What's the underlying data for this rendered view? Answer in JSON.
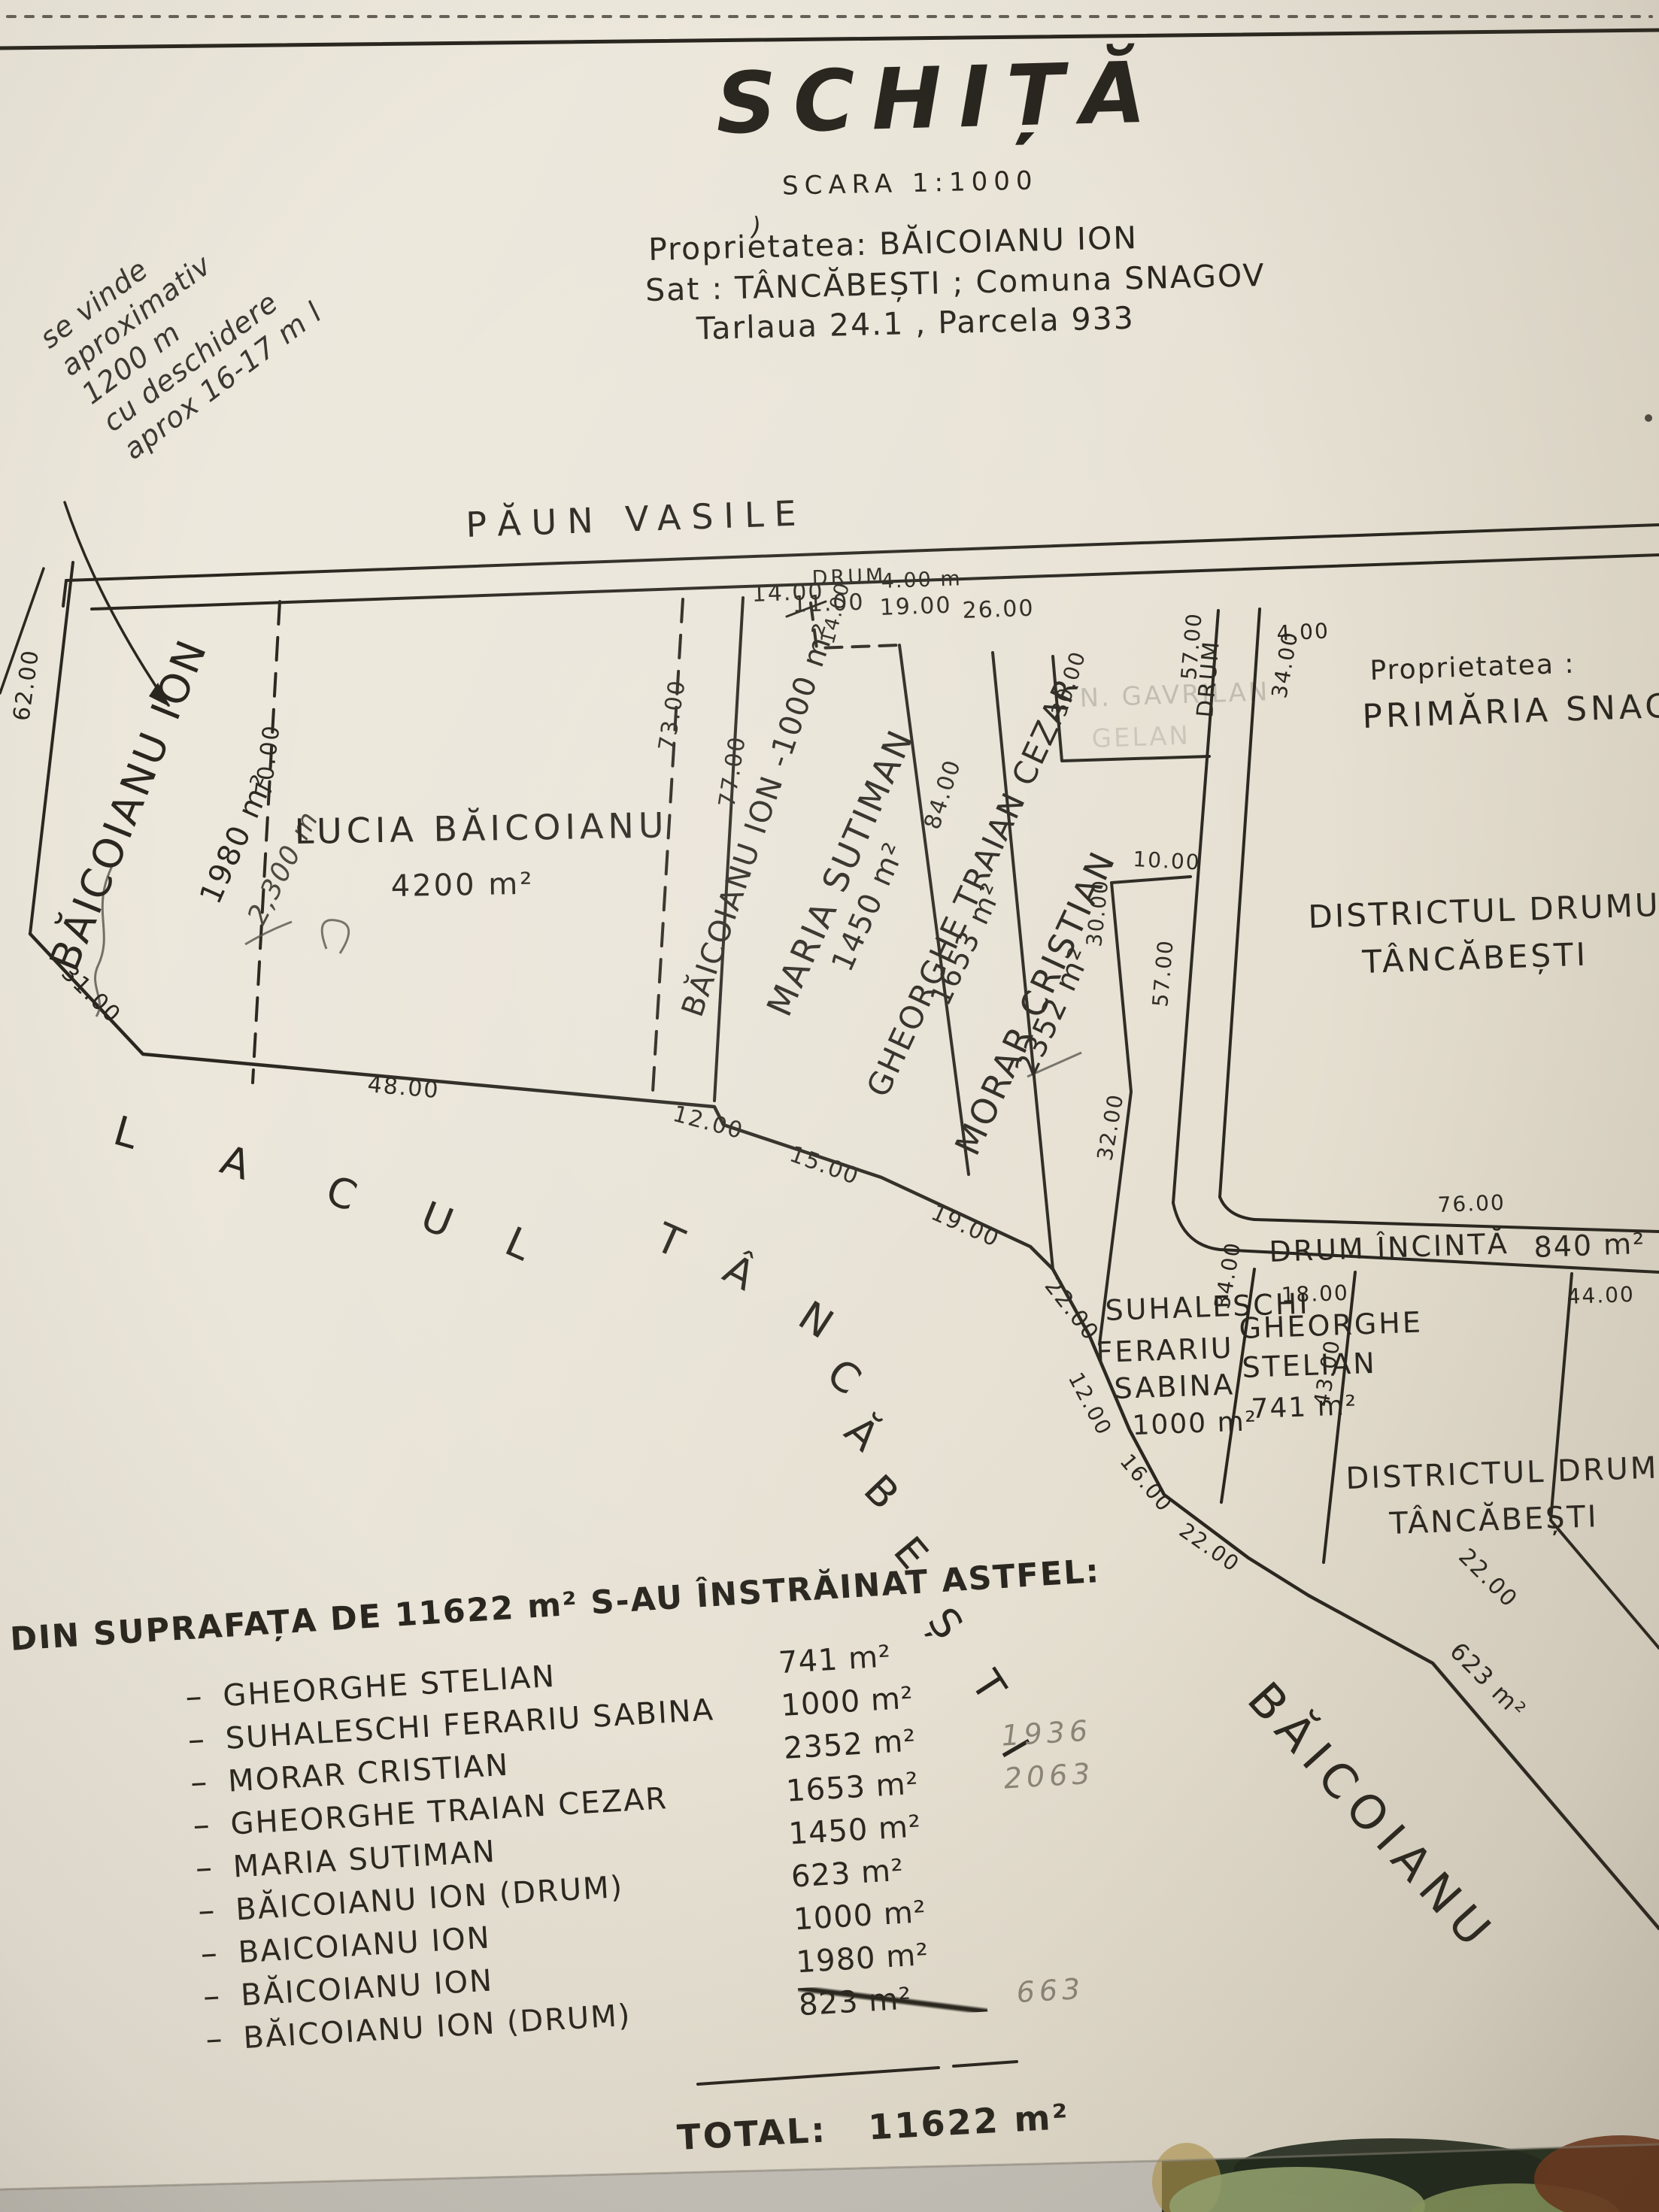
{
  "photo": {
    "paper_color": "#e9e4d8",
    "ink_color": "#29261f"
  },
  "header": {
    "title": "SCHIȚĂ",
    "scale": "SCARA 1:1000",
    "owner": "Proprietatea: BĂICOIANU ION",
    "location": "Sat : TÂNCĂBEȘTI ; Comuna SNAGOV",
    "plot": "Tarlaua 24.1 , Parcela 933",
    "stray_mark": ")"
  },
  "handwritten_note": {
    "lines": [
      "se vinde",
      "aproximativ",
      "1200 m",
      "cu deschidere",
      "aprox 16-17 m l"
    ]
  },
  "map": {
    "north_label": "PĂUN VASILE",
    "lake_name": "LACULTÂNCĂBEȘTI",
    "labels": {
      "paun": "PĂUN VASILE",
      "drumtop": "DRUM",
      "drumtopw": "4.00 m",
      "p1name": "BĂICOIANU ION",
      "p1area": "1980 m²",
      "p1hand": "2,300 m",
      "p2name": "LUCIA BĂICOIANU",
      "p2area": "4200 m²",
      "p3name": "BĂICOIANU ION -1000 m²",
      "p4name": "MARIA SUTIMAN",
      "p4area": "1450 m²",
      "p5name": "GHEORGHE TRAIAN CEZAR",
      "p5area": "1653 m²",
      "p6name": "MORAR CRISTIAN",
      "p6area": "2352 m²",
      "faded1": "N. GAVRILAN",
      "faded2": "GELAN",
      "drumv": "DRUM",
      "propright": "Proprietatea :",
      "primaria": "PRIMĂRIA SNAGOV",
      "d1a": "DISTRICTUL DRUMURI",
      "d1b": "TÂNCĂBEȘTI",
      "incinta": "DRUM ÎNCINTĂ",
      "incintaarea": "840 m²",
      "suh1": "SUHALESCHI",
      "suh2": "FERARIU",
      "suh3": "SABINA",
      "suh4": "1000 m²",
      "stel1": "GHEORGHE",
      "stel2": "STELIAN",
      "stel3": "741 m²",
      "d2a": "DISTRICTUL DRUMURI",
      "d2b": "TÂNCĂBEȘTI",
      "strip": "BĂICOIANU"
    },
    "measurements": {
      "t14": "14.00",
      "t11": "11.00",
      "t14b": "14.00",
      "t19": "19.00",
      "t26": "26.00",
      "r4": "4.00",
      "r34": "34.00",
      "l62": "62.00",
      "l70": "70.00",
      "l73": "73.00",
      "l77": "77.00",
      "l84": "84.00",
      "s31": "31.00",
      "s48": "48.00",
      "s12": "12.00",
      "s15": "15.00",
      "s19": "19.00",
      "s22": "22.00",
      "n30a": "30.00",
      "n10": "10.00",
      "n30b": "30.00",
      "n32": "32.00",
      "d57a": "57.00",
      "d57b": "57.00",
      "i76": "76.00",
      "i18": "18.00",
      "i44": "44.00",
      "s12b": "12.00",
      "s16": "16.00",
      "s22b": "22.00",
      "s34": "34.00",
      "s43": "43.00",
      "k22": "22.00",
      "k623": "623 m²"
    }
  },
  "summary": {
    "heading": "DIN SUPRAFAȚA DE 11622 m² S-AU ÎNSTRĂINAT ASTFEL:",
    "items": [
      {
        "name": "GHEORGHE STELIAN",
        "area": "741 m²",
        "note": "",
        "struck": false
      },
      {
        "name": "SUHALESCHI FERARIU SABINA",
        "area": "1000 m²",
        "note": "",
        "struck": false
      },
      {
        "name": "MORAR CRISTIAN",
        "area": "2352 m²",
        "note": "1936",
        "struck": false
      },
      {
        "name": "GHEORGHE TRAIAN CEZAR",
        "area": "1653 m²",
        "note": "2063",
        "struck": false
      },
      {
        "name": "MARIA SUTIMAN",
        "area": "1450 m²",
        "note": "",
        "struck": false
      },
      {
        "name": "BĂICOIANU ION (DRUM)",
        "area": "623 m²",
        "note": "",
        "struck": false
      },
      {
        "name": "BAICOIANU ION",
        "area": "1000 m²",
        "note": "",
        "struck": false
      },
      {
        "name": "BĂICOIANU ION",
        "area": "1980 m²",
        "note": "",
        "struck": false
      },
      {
        "name": "BĂICOIANU ION (DRUM)",
        "area": "823 m²",
        "note": "663",
        "struck": true
      }
    ],
    "total_label": "TOTAL:",
    "total_value": "11622 m²"
  }
}
